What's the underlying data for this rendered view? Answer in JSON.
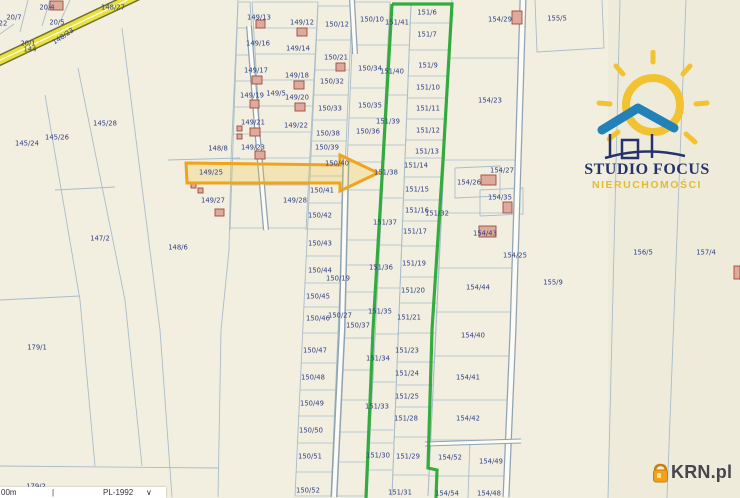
{
  "map": {
    "bg": "#f2efe1",
    "right_region_fill": "#efebdb",
    "label_color": "#303f85",
    "line_color": "#a9bcc9",
    "building_fill": "#dcab9e",
    "building_stroke": "#9e4a3a",
    "parcels": [
      [
        "22",
        3,
        23
      ],
      [
        "20/4",
        47,
        7
      ],
      [
        "20/7",
        14,
        17
      ],
      [
        "20/5",
        57,
        22
      ],
      [
        "20/1",
        28,
        43
      ],
      [
        "144",
        30,
        49
      ],
      [
        "148/27",
        113,
        7
      ],
      [
        "145/28",
        105,
        123
      ],
      [
        "145/26",
        57,
        137
      ],
      [
        "145/24",
        27,
        143
      ],
      [
        "148/8",
        218,
        148
      ],
      [
        "147/2",
        100,
        238
      ],
      [
        "148/6",
        178,
        247
      ],
      [
        "179/1",
        37,
        347
      ],
      [
        "179/2",
        36,
        486
      ],
      [
        "149/13",
        259,
        17
      ],
      [
        "149/12",
        302,
        22
      ],
      [
        "149/16",
        258,
        43
      ],
      [
        "149/14",
        298,
        48
      ],
      [
        "149/17",
        256,
        70
      ],
      [
        "149/18",
        297,
        75
      ],
      [
        "149/19",
        252,
        95
      ],
      [
        "149/5",
        276,
        93
      ],
      [
        "149/20",
        297,
        97
      ],
      [
        "149/21",
        253,
        122
      ],
      [
        "149/22",
        296,
        125
      ],
      [
        "149/23",
        253,
        147
      ],
      [
        "149/25",
        211,
        172
      ],
      [
        "149/27",
        213,
        200
      ],
      [
        "149/28",
        295,
        200
      ],
      [
        "150/12",
        337,
        24
      ],
      [
        "150/10",
        372,
        19
      ],
      [
        "150/21",
        336,
        57
      ],
      [
        "150/34",
        370,
        68
      ],
      [
        "150/32",
        332,
        81
      ],
      [
        "150/33",
        330,
        108
      ],
      [
        "150/35",
        370,
        105
      ],
      [
        "150/38",
        328,
        133
      ],
      [
        "150/36",
        368,
        131
      ],
      [
        "150/39",
        327,
        147
      ],
      [
        "150/40",
        337,
        163
      ],
      [
        "150/41",
        322,
        190
      ],
      [
        "150/42",
        320,
        215
      ],
      [
        "150/43",
        320,
        243
      ],
      [
        "150/44",
        320,
        270
      ],
      [
        "150/19",
        338,
        278
      ],
      [
        "150/45",
        318,
        296
      ],
      [
        "150/46",
        318,
        318
      ],
      [
        "150/27",
        340,
        315
      ],
      [
        "150/37",
        358,
        325
      ],
      [
        "150/47",
        315,
        350
      ],
      [
        "150/48",
        313,
        377
      ],
      [
        "150/49",
        312,
        403
      ],
      [
        "150/50",
        311,
        430
      ],
      [
        "150/51",
        310,
        456
      ],
      [
        "150/52",
        308,
        490
      ],
      [
        "151/41",
        397,
        22
      ],
      [
        "151/40",
        392,
        71
      ],
      [
        "151/39",
        388,
        121
      ],
      [
        "151/38",
        386,
        172
      ],
      [
        "151/37",
        385,
        222
      ],
      [
        "151/36",
        381,
        267
      ],
      [
        "151/35",
        380,
        311
      ],
      [
        "151/34",
        378,
        358
      ],
      [
        "151/33",
        377,
        406
      ],
      [
        "151/30",
        378,
        455
      ],
      [
        "151/6",
        427,
        12
      ],
      [
        "151/7",
        427,
        34
      ],
      [
        "151/9",
        428,
        65
      ],
      [
        "151/10",
        428,
        87
      ],
      [
        "151/11",
        428,
        108
      ],
      [
        "151/12",
        428,
        130
      ],
      [
        "151/13",
        427,
        151
      ],
      [
        "151/14",
        416,
        165
      ],
      [
        "151/15",
        417,
        189
      ],
      [
        "151/16",
        417,
        210
      ],
      [
        "151/17",
        415,
        231
      ],
      [
        "151/19",
        414,
        263
      ],
      [
        "151/20",
        413,
        290
      ],
      [
        "151/21",
        409,
        317
      ],
      [
        "151/23",
        407,
        350
      ],
      [
        "151/24",
        407,
        373
      ],
      [
        "151/25",
        407,
        396
      ],
      [
        "151/28",
        406,
        418
      ],
      [
        "151/29",
        408,
        456
      ],
      [
        "151/31",
        400,
        492
      ],
      [
        "151/32",
        437,
        213
      ],
      [
        "154/29",
        500,
        19
      ],
      [
        "154/23",
        490,
        100
      ],
      [
        "154/27",
        502,
        170
      ],
      [
        "154/26",
        469,
        182
      ],
      [
        "154/35",
        500,
        197
      ],
      [
        "154/43",
        485,
        233
      ],
      [
        "154/25",
        515,
        255
      ],
      [
        "154/44",
        478,
        287
      ],
      [
        "154/40",
        473,
        335
      ],
      [
        "154/41",
        468,
        377
      ],
      [
        "154/42",
        468,
        418
      ],
      [
        "154/52",
        450,
        457
      ],
      [
        "154/49",
        491,
        461
      ],
      [
        "154/54",
        447,
        493
      ],
      [
        "154/48",
        489,
        493
      ],
      [
        "155/5",
        557,
        18
      ],
      [
        "155/9",
        553,
        282
      ],
      [
        "156/5",
        643,
        252
      ],
      [
        "157/4",
        706,
        252
      ]
    ],
    "rotated_labels": [
      [
        "148/23",
        63,
        36,
        -34
      ]
    ],
    "buildings": [
      [
        50,
        1,
        13,
        9
      ],
      [
        256,
        20,
        9,
        8
      ],
      [
        297,
        28,
        10,
        8
      ],
      [
        336,
        63,
        9,
        8
      ],
      [
        252,
        76,
        10,
        8
      ],
      [
        294,
        81,
        10,
        8
      ],
      [
        250,
        100,
        9,
        8
      ],
      [
        295,
        103,
        10,
        8
      ],
      [
        250,
        128,
        10,
        8
      ],
      [
        255,
        151,
        10,
        8
      ],
      [
        191,
        183,
        5,
        5
      ],
      [
        198,
        188,
        5,
        5
      ],
      [
        215,
        209,
        9,
        7
      ],
      [
        237,
        126,
        5,
        5
      ],
      [
        237,
        134,
        5,
        5
      ],
      [
        512,
        11,
        10,
        13
      ],
      [
        481,
        175,
        15,
        10
      ],
      [
        503,
        202,
        9,
        11
      ],
      [
        479,
        226,
        17,
        11
      ],
      [
        734,
        266,
        6,
        13
      ]
    ],
    "boundaries": [
      "45,95 80,300 95,466",
      "78,68 125,300 142,466",
      "122,28 160,330 172,497",
      "238,0 231,160 229,250 221,330 218,497",
      "168,160 240,158",
      "55,190 115,187",
      "0,300 80,296",
      "0,466 218,468",
      "28,0 20,32",
      "50,0 42,26",
      "70,0 60,22",
      "0,34 14,24",
      "535,0 537,52 604,48 602,0",
      "620,0 608,498",
      "686,0 667,498",
      "455,168 500,166 500,196 455,198 455,168",
      "480,190 523,188 523,214 480,216 480,190",
      "470,440 468,498"
    ],
    "columns": [
      {
        "left": [
          238,
          230
        ],
        "right": [
          250,
          264
        ],
        "top": 2,
        "bottom": 230,
        "rows": [
          2,
          28,
          55,
          81,
          107,
          134,
          159,
          185,
          228
        ]
      },
      {
        "left": [
          252,
          266
        ],
        "right": [
          318,
          306
        ],
        "top": 2,
        "bottom": 230,
        "rows": [
          2,
          28,
          54,
          80,
          106,
          132,
          158,
          185,
          228
        ]
      },
      {
        "left": [
          318,
          295
        ],
        "right": [
          352,
          331
        ],
        "top": 6,
        "bottom": 496,
        "rows": [
          6,
          40,
          70,
          95,
          120,
          141,
          156,
          176,
          203,
          229,
          256,
          283,
          307,
          333,
          363,
          390,
          416,
          443,
          472,
          496
        ]
      },
      {
        "left": [
          354,
          333
        ],
        "right": [
          390,
          365
        ],
        "top": 2,
        "bottom": 496,
        "rows": [
          2,
          45,
          88,
          118,
          145,
          162,
          190,
          240,
          265,
          292,
          310,
          338,
          370,
          400,
          432,
          462,
          496
        ]
      },
      {
        "left": [
          392,
          367
        ],
        "right": [
          411,
          392
        ],
        "top": 4,
        "bottom": 496,
        "rows": [
          45,
          95,
          145,
          198,
          245,
          288,
          334,
          382,
          430,
          443,
          470
        ]
      },
      {
        "left": [
          411,
          392
        ],
        "right": [
          451,
          428
        ],
        "top": 4,
        "bottom": 496,
        "rows": [
          23,
          50,
          76,
          98,
          119,
          140,
          158,
          177,
          200,
          221,
          246,
          277,
          303,
          333,
          362,
          385,
          407,
          437,
          475
        ]
      },
      {
        "left": [
          452,
          428
        ],
        "right": [
          521,
          508
        ],
        "top": 0,
        "bottom": 496,
        "rows": [
          58,
          160,
          213,
          268,
          312,
          356,
          400,
          440,
          476
        ]
      }
    ],
    "roads": [
      {
        "pts": "249,26 257,128 266,230",
        "outer": 6,
        "inner": 3.5
      },
      {
        "pts": "352,0 355,54",
        "outer": 6,
        "inner": 3.5
      },
      {
        "pts": "346,158 342,330 334,497",
        "outer": 7,
        "inner": 4
      },
      {
        "pts": "523,0 513,330 506,497",
        "outer": 7,
        "inner": 4.5
      },
      {
        "pts": "425,444 521,441",
        "outer": 5,
        "inner": 3
      }
    ],
    "road_casing": "#8fa3b3",
    "road_fill": "#fcfbf6",
    "yellow_road": {
      "pts": "-6,63 140,-6",
      "casing": 11,
      "band": 8,
      "center": 1.2,
      "casing_color": "#6f7030",
      "band_color": "#e9e13e",
      "center_color": "#fffdf0"
    },
    "green_outline": {
      "color": "#29a837",
      "width": 3.2,
      "paths": [
        "392,4 452,4 443,160 432,330 428,468 437,470 436,498",
        "392,4 383,160 373,330 366,498"
      ]
    },
    "arrow": {
      "stroke": "#f0a31c",
      "width": 3,
      "fill": "rgba(244,196,48,0.25)",
      "points": "186,163 340,165 340,155 378,173 340,191 340,183 187,183"
    }
  },
  "logo_studio": {
    "line1": "STUDIO FOCUS",
    "line2": "NIERUCHOMOŚCI",
    "navy": "#26336b",
    "yellow": "#e3bc2e",
    "sun_color": "#f2c230",
    "roof_color": "#2282b8"
  },
  "logo_krn": {
    "text": "KRN.pl",
    "icon_color": "#f2a218",
    "icon_dark": "#c87f10"
  },
  "scalebar": {
    "distance": "00m",
    "tick": "|",
    "crs": "PL-1992",
    "chevron": "∨"
  }
}
